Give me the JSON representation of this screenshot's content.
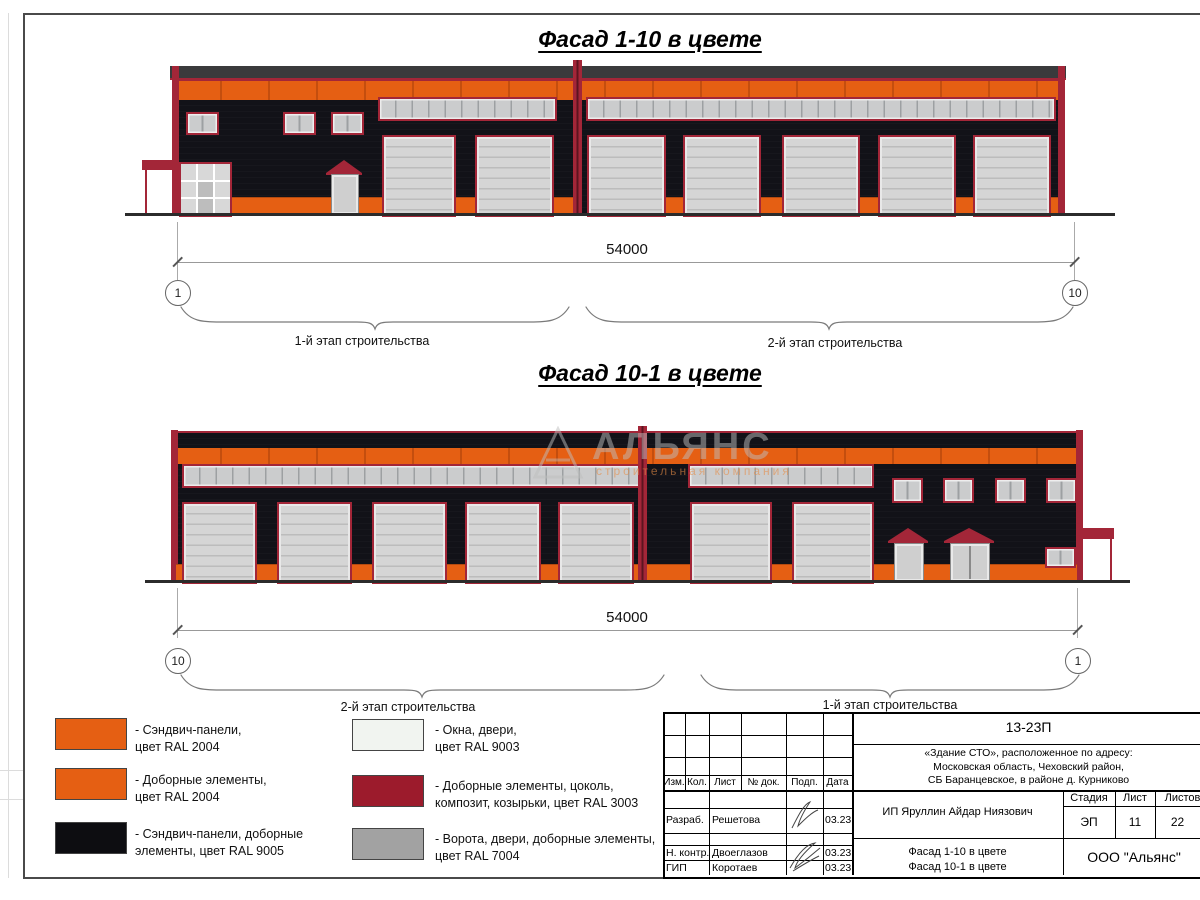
{
  "colors": {
    "orange": "#e55f13",
    "orange_joint": "#c44e0e",
    "red": "#a32638",
    "roof": "#3a3a3c",
    "gate": "#d5d5d5",
    "glass": "#cbcccd"
  },
  "facade1": {
    "title": "Фасад 1-10 в цвете",
    "dimension": "54000",
    "axis_left": "1",
    "axis_right": "10",
    "stage_left": "1-й этап строительства",
    "stage_right": "2-й этап строительства"
  },
  "facade2": {
    "title": "Фасад 10-1 в цвете",
    "dimension": "54000",
    "axis_left": "10",
    "axis_right": "1",
    "stage_left": "2-й этап строительства",
    "stage_right": "1-й этап строительства"
  },
  "watermark": {
    "name": "АЛЬЯНС",
    "subtitle": "строительная компания"
  },
  "legend": [
    {
      "color": "#e55f13",
      "label": "- Сэндвич-панели,\nцвет RAL 2004"
    },
    {
      "color": "#e55f13",
      "label": "- Доборные элементы,\nцвет RAL 2004"
    },
    {
      "color": "#0d0d11",
      "label": "- Сэндвич-панели, доборные\nэлементы, цвет RAL 9005"
    },
    {
      "color": "#f1f4f0",
      "label": "- Окна, двери,\nцвет RAL 9003"
    },
    {
      "color": "#9c1b2c",
      "label": "- Доборные элементы, цоколь,\nкомпозит, козырьки, цвет RAL 3003"
    },
    {
      "color": "#a2a2a2",
      "label": "- Ворота, двери, доборные элементы,\nцвет RAL 7004"
    }
  ],
  "titleblock": {
    "doc_number": "13-23П",
    "address": "«Здание СТО», расположенное по адресу:\nМосковская область, Чеховский район,\nСБ Баранцевское, в районе д. Курниково",
    "header": {
      "izm": "Изм.",
      "kol": "Кол.",
      "list": "Лист",
      "doc": "№ док.",
      "podp": "Подп.",
      "data": "Дата"
    },
    "rows": [
      {
        "role": "Разраб.",
        "name": "Решетова",
        "date": "03.23"
      },
      {
        "role": "Н. контр.",
        "name": "Двоеглазов",
        "date": "03.23"
      },
      {
        "role": "ГИП",
        "name": "Коротаев",
        "date": "03.23"
      }
    ],
    "client": "ИП Яруллин Айдар Ниязович",
    "sheet_title": "Фасад 1-10 в цвете\nФасад 10-1 в цвете",
    "stage_label": "Стадия",
    "stage_value": "ЭП",
    "list_label": "Лист",
    "list_value": "11",
    "listov_label": "Листов",
    "listov_value": "22",
    "company": "ООО \"Альянс\""
  }
}
